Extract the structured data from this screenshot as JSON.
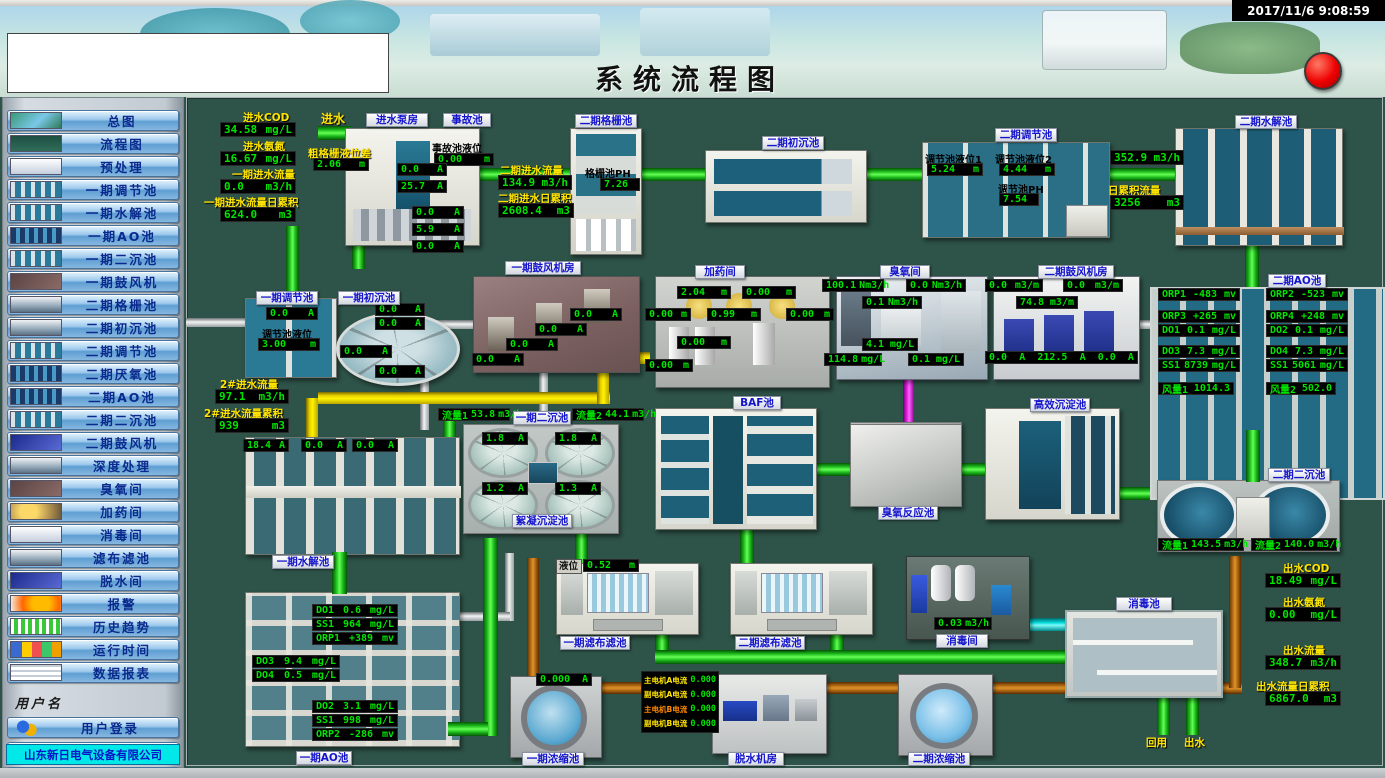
{
  "window": {
    "timestamp": "2017/11/6 9:08:59",
    "title": "系统流程图",
    "company": "山东新日电气设备有限公司"
  },
  "sidebar": {
    "username_label": "用户名",
    "items": [
      {
        "label": "总图",
        "thumb": "photo"
      },
      {
        "label": "流程图",
        "thumb": "flow"
      },
      {
        "label": "预处理",
        "thumb": "white"
      },
      {
        "label": "一期调节池",
        "thumb": "pools"
      },
      {
        "label": "一期水解池",
        "thumb": "pools"
      },
      {
        "label": "一期AO池",
        "thumb": "grid"
      },
      {
        "label": "一期二沉池",
        "thumb": "pools"
      },
      {
        "label": "一期鼓风机",
        "thumb": "dark"
      },
      {
        "label": "二期格栅池",
        "thumb": "machine"
      },
      {
        "label": "二期初沉池",
        "thumb": "machine"
      },
      {
        "label": "二期调节池",
        "thumb": "pools"
      },
      {
        "label": "二期厌氧池",
        "thumb": "grid"
      },
      {
        "label": "二期AO池",
        "thumb": "grid"
      },
      {
        "label": "二期二沉池",
        "thumb": "pools"
      },
      {
        "label": "二期鼓风机",
        "thumb": "blue"
      },
      {
        "label": "深度处理",
        "thumb": "machine"
      },
      {
        "label": "臭氧间",
        "thumb": "dark"
      },
      {
        "label": "加药间",
        "thumb": "yellow"
      },
      {
        "label": "消毒间",
        "thumb": "white"
      },
      {
        "label": "滤布滤池",
        "thumb": "machine"
      },
      {
        "label": "脱水间",
        "thumb": "blue"
      },
      {
        "label": "报警",
        "thumb": "alarm"
      },
      {
        "label": "历史趋势",
        "thumb": "trend"
      },
      {
        "label": "运行时间",
        "thumb": "runtime"
      },
      {
        "label": "数据报表",
        "thumb": "report"
      }
    ],
    "user_buttons": [
      {
        "label": "用户登录",
        "icon": "user-login-icon"
      },
      {
        "label": "用户注销",
        "icon": "user-logout-icon"
      },
      {
        "label": "退出运行",
        "icon": "exit-icon"
      }
    ]
  },
  "d": {
    "kin": {
      "cod_l": "进水COD",
      "cod": [
        "34.58",
        "mg/L"
      ],
      "nh_l": "进水氨氮",
      "nh": [
        "16.67",
        "mg/L"
      ],
      "fl_l": "一期进水流量",
      "fl": [
        "0.0",
        "m3/h"
      ],
      "tt_l": "一期进水流量日累积",
      "tt": [
        "624.0",
        "m3"
      ]
    },
    "inlet": "进水",
    "pump": {
      "chip": "进水泵房",
      "coarse_l": "粗格栅液位差",
      "coarse": [
        "2.06",
        "m"
      ],
      "c": [
        [
          "0.0",
          "A"
        ],
        [
          "25.7",
          "A"
        ],
        [
          "0.0",
          "A"
        ],
        [
          "5.9",
          "A"
        ],
        [
          "0.0",
          "A"
        ]
      ]
    },
    "acc": {
      "chip": "事故池",
      "lvl_l": "事故池液位",
      "lvl": [
        "0.00",
        "m"
      ]
    },
    "p2": {
      "fl_l": "二期进水流量",
      "fl": [
        "134.9",
        "m3/h"
      ],
      "tt_l": "二期进水日累积",
      "tt": [
        "2608.4",
        "m3"
      ]
    },
    "gr2": {
      "chip": "二期格栅池",
      "ph_l": "格栅池PH",
      "ph": "7.26"
    },
    "pr2": {
      "chip": "二期初沉池"
    },
    "rg2": {
      "chip": "二期调节池",
      "l1_l": "调节池液位1",
      "l1": [
        "5.24",
        "m"
      ],
      "l2_l": "调节池液位2",
      "l2": [
        "4.44",
        "m"
      ],
      "ph_l": "调节池PH",
      "ph": "7.54"
    },
    "hy2": {
      "chip": "二期水解池",
      "fl": [
        "352.9",
        "m3/h"
      ],
      "tt_l": "日累积流量",
      "tt": [
        "3256",
        "m3"
      ]
    },
    "ao2": {
      "chip": "二期AO池",
      "rows": [
        [
          "ORP1",
          "-483",
          "mv"
        ],
        [
          "ORP2",
          "-523",
          "mv"
        ],
        [
          "ORP3",
          "+265",
          "mv"
        ],
        [
          "ORP4",
          "+248",
          "mv"
        ],
        [
          "DO1",
          "0.1",
          "mg/L"
        ],
        [
          "DO2",
          "0.1",
          "mg/L"
        ],
        [
          "DO3",
          "7.3",
          "mg/L"
        ],
        [
          "DO4",
          "7.3",
          "mg/L"
        ],
        [
          "SS1",
          "8739",
          "mg/L"
        ],
        [
          "SS1",
          "5061",
          "mg/L"
        ],
        [
          "风量1",
          "1014.3",
          ""
        ],
        [
          "风量2",
          "502.0",
          ""
        ]
      ]
    },
    "rg1": {
      "chip": "一期调节池",
      "c": [
        "0.0",
        "A"
      ],
      "lvl_l": "调节池液位",
      "lvl": [
        "3.00",
        "m"
      ]
    },
    "pr1": {
      "chip": "一期初沉池",
      "c": [
        [
          "0.0",
          "A"
        ],
        [
          "0.0",
          "A"
        ],
        [
          "0.0",
          "A"
        ],
        [
          "0.0",
          "A"
        ]
      ]
    },
    "bl1": {
      "chip": "一期鼓风机房",
      "c": [
        [
          "0.0",
          "A"
        ],
        [
          "0.0",
          "A"
        ],
        [
          "0.0",
          "A"
        ],
        [
          "0.0",
          "A"
        ]
      ]
    },
    "dos": {
      "chip": "加药间",
      "lv": [
        [
          "2.04",
          "m"
        ],
        [
          "0.00",
          "m"
        ],
        [
          "0.00",
          "m"
        ],
        [
          "0.99",
          "m"
        ],
        [
          "0.00",
          "m"
        ],
        [
          "0.00",
          "m"
        ],
        [
          "0.00",
          "m"
        ]
      ]
    },
    "oz": {
      "chip": "臭氧间",
      "v": [
        [
          "100.1",
          "Nm3/h"
        ],
        [
          "0.0",
          "Nm3/h"
        ],
        [
          "0.1",
          "Nm3/h"
        ],
        [
          "4.1",
          "mg/L"
        ],
        [
          "114.8",
          "mg/L"
        ],
        [
          "0.1",
          "mg/L"
        ]
      ]
    },
    "bl2": {
      "chip": "二期鼓风机房",
      "v": [
        [
          "0.0",
          "m3/m"
        ],
        [
          "0.0",
          "m3/m"
        ],
        [
          "74.8",
          "m3/m"
        ]
      ],
      "row": [
        "0.0",
        "A",
        "212.5",
        "A",
        "0.0",
        "A"
      ]
    },
    "f2": {
      "fl_l": "2#进水流量",
      "fl": [
        "97.1",
        "m3/h"
      ],
      "tt_l": "2#进水流量累积",
      "tt": [
        "939",
        "m3"
      ]
    },
    "hy1": {
      "chip": "一期水解池",
      "c": [
        [
          "18.4",
          "A"
        ],
        [
          "0.0",
          "A"
        ],
        [
          "0.0",
          "A"
        ]
      ]
    },
    "ao1": {
      "chip": "一期AO池",
      "g1": [
        [
          "DO1",
          "0.6",
          "mg/L"
        ],
        [
          "SS1",
          "964",
          "mg/L"
        ],
        [
          "ORP1",
          "+389",
          "mv"
        ]
      ],
      "g2": [
        [
          "DO3",
          "9.4",
          "mg/L"
        ],
        [
          "DO4",
          "0.5",
          "mg/L"
        ]
      ],
      "g3": [
        [
          "DO2",
          "3.1",
          "mg/L"
        ],
        [
          "SS1",
          "998",
          "mg/L"
        ],
        [
          "ORP2",
          "-286",
          "mv"
        ]
      ]
    },
    "s1": {
      "chip": "一期二沉池",
      "f1": [
        "流量1",
        "53.8",
        "m3/h"
      ],
      "f2": [
        "流量2",
        "44.1",
        "m3/h"
      ],
      "c": [
        [
          "1.8",
          "A"
        ],
        [
          "1.8",
          "A"
        ],
        [
          "1.2",
          "A"
        ],
        [
          "1.3",
          "A"
        ]
      ]
    },
    "floc": {
      "chip": "絮凝沉淀池"
    },
    "baf": {
      "chip": "BAF池"
    },
    "ozr": {
      "chip": "臭氧反应池"
    },
    "hes": {
      "chip": "高效沉淀池"
    },
    "s2": {
      "chip": "二期二沉池",
      "f1": [
        "流量1",
        "143.5",
        "m3/h"
      ],
      "f2": [
        "流量2",
        "140.0",
        "m3/h"
      ]
    },
    "fc1": {
      "chip": "一期滤布滤池",
      "lvl_l": "液位",
      "lvl": [
        "0.52",
        "m"
      ]
    },
    "fc2": {
      "chip": "二期滤布滤池"
    },
    "dr": {
      "chip": "消毒间",
      "fl": [
        "0.03",
        "m3/h"
      ]
    },
    "dp": {
      "chip": "消毒池"
    },
    "out": {
      "cod_l": "出水COD",
      "cod": [
        "18.49",
        "mg/L"
      ],
      "nh_l": "出水氨氮",
      "nh": [
        "0.00",
        "mg/L"
      ],
      "fl_l": "出水流量",
      "fl": [
        "348.7",
        "m3/h"
      ],
      "tt_l": "出水流量日累积",
      "tt": [
        "6867.0",
        "m3"
      ]
    },
    "th1": {
      "chip": "一期浓缩池",
      "c": [
        "0.000",
        "A"
      ]
    },
    "mot": {
      "rows": [
        [
          "主电机A电流",
          "0.000"
        ],
        [
          "副电机A电流",
          "0.000"
        ],
        [
          "主电机B电流",
          "0.000"
        ],
        [
          "副电机B电流",
          "0.000"
        ]
      ]
    },
    "dw": {
      "chip": "脱水机房"
    },
    "th2": {
      "chip": "二期浓缩池"
    },
    "reuse": "回用",
    "outw": "出水"
  },
  "colors": {
    "accent_green": "#00e400",
    "label_yellow": "#ffe400",
    "chip_blue": "#1414cc",
    "alarm_red": "#ee0000"
  }
}
